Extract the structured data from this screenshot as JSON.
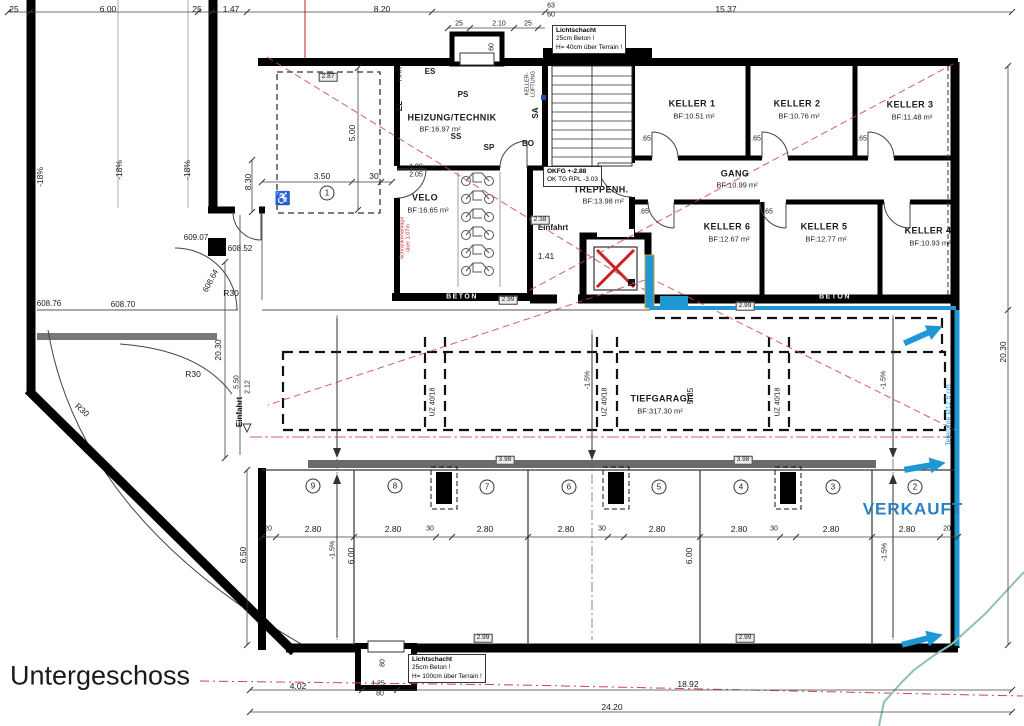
{
  "page_title": "Untergeschoss",
  "colors": {
    "accent_blue": "#1f97d4",
    "verkauft_blue": "#2b7fc4",
    "red_dashed": "#cc4444",
    "beam_gray": "#6a6a6a",
    "terrain_teal": "#8fc0b8",
    "wall_black": "#000000"
  },
  "callouts": [
    {
      "n": "lichtschacht-callout-top",
      "x": 552,
      "y": 25,
      "lines": [
        "Lichtschacht",
        "25cm Beton !",
        "H= 40cm über Terrain !"
      ]
    },
    {
      "n": "okfg-callout",
      "x": 543,
      "y": 166,
      "lines": [
        "OKFG +-2.88",
        "OK TG RPL -3.03"
      ]
    },
    {
      "n": "lichtschacht-callout-bottom",
      "x": 408,
      "y": 654,
      "lines": [
        "Lichtschacht",
        "25cm Beton !",
        "H= 100cm über Terrain !"
      ]
    }
  ],
  "labels": [
    {
      "t": "25",
      "x": 14,
      "y": 9
    },
    {
      "t": "6.00",
      "x": 108,
      "y": 9
    },
    {
      "t": "25",
      "x": 197,
      "y": 9
    },
    {
      "t": "1.47",
      "x": 231,
      "y": 9
    },
    {
      "t": "8.20",
      "x": 382,
      "y": 9
    },
    {
      "t": "63",
      "x": 551,
      "y": 6,
      "c": "d7"
    },
    {
      "t": "60",
      "x": 551,
      "y": 15,
      "c": "d7"
    },
    {
      "t": "15.37",
      "x": 726,
      "y": 9
    },
    {
      "t": "25",
      "x": 459,
      "y": 24,
      "c": "d7"
    },
    {
      "t": "2.10",
      "x": 499,
      "y": 24,
      "c": "d7"
    },
    {
      "t": "25",
      "x": 528,
      "y": 24,
      "c": "d7"
    },
    {
      "t": "60",
      "x": 492,
      "y": 47,
      "r": -90,
      "c": "d7"
    },
    {
      "t": "-18%",
      "x": 40,
      "y": 177,
      "r": -90,
      "c": "slope"
    },
    {
      "t": "-18%",
      "x": 119,
      "y": 170,
      "r": -90,
      "c": "slope"
    },
    {
      "t": "-18%",
      "x": 187,
      "y": 170,
      "r": -90,
      "c": "slope"
    },
    {
      "t": "609.07",
      "x": 196,
      "y": 238,
      "c": "lvl"
    },
    {
      "t": "608.52",
      "x": 240,
      "y": 249,
      "c": "lvl"
    },
    {
      "t": "608.64",
      "x": 211,
      "y": 281,
      "r": -62,
      "c": "lvl"
    },
    {
      "t": "608.76",
      "x": 49,
      "y": 304,
      "c": "lvl"
    },
    {
      "t": "608.70",
      "x": 123,
      "y": 305,
      "c": "lvl"
    },
    {
      "t": "R30",
      "x": 231,
      "y": 293
    },
    {
      "t": "R30",
      "x": 193,
      "y": 374
    },
    {
      "t": "R30",
      "x": 82,
      "y": 410,
      "r": 42
    },
    {
      "t": "8.30",
      "x": 248,
      "y": 182,
      "r": -90
    },
    {
      "t": "20.30",
      "x": 218,
      "y": 350,
      "r": -90
    },
    {
      "t": "5.50",
      "x": 237,
      "y": 382,
      "r": -90,
      "c": "d7"
    },
    {
      "t": "2.12",
      "x": 248,
      "y": 387,
      "r": -90,
      "c": "d7"
    },
    {
      "t": "Einfahrt",
      "x": 240,
      "y": 412,
      "r": -90,
      "c": "dbold"
    },
    {
      "t": "6.50",
      "x": 243,
      "y": 555,
      "r": -90
    },
    {
      "t": "3.50",
      "x": 322,
      "y": 176
    },
    {
      "t": "30",
      "x": 374,
      "y": 176
    },
    {
      "t": "5.00",
      "x": 352,
      "y": 133,
      "r": -90
    },
    {
      "t": "1.08",
      "x": 416,
      "y": 167,
      "c": "d7"
    },
    {
      "t": "2.05",
      "x": 416,
      "y": 175,
      "c": "d7"
    },
    {
      "t": "HEIZUNG/TECHNIK",
      "x": 452,
      "y": 118,
      "c": "room",
      "n": "room-label-heizung"
    },
    {
      "t": "BF:16.97 m²",
      "x": 440,
      "y": 129,
      "c": "area"
    },
    {
      "t": "ES",
      "x": 430,
      "y": 72,
      "c": "dbold"
    },
    {
      "t": "PS",
      "x": 463,
      "y": 95,
      "c": "dbold"
    },
    {
      "t": "SS",
      "x": 456,
      "y": 137,
      "c": "dbold"
    },
    {
      "t": "SP",
      "x": 489,
      "y": 148,
      "c": "dbold"
    },
    {
      "t": "BO",
      "x": 528,
      "y": 144,
      "c": "dbold"
    },
    {
      "t": "EL",
      "x": 400,
      "y": 106,
      "r": -90,
      "c": "dbold"
    },
    {
      "t": "HAK",
      "x": 400,
      "y": 74,
      "r": -90,
      "c": "d7"
    },
    {
      "t": "KELLER-",
      "x": 528,
      "y": 84,
      "r": -90,
      "c": "d6"
    },
    {
      "t": "LÜFTUNG",
      "x": 534,
      "y": 84,
      "r": -90,
      "c": "d6"
    },
    {
      "t": "SA",
      "x": 536,
      "y": 113,
      "r": -90,
      "c": "dbold"
    },
    {
      "t": "VELO",
      "x": 425,
      "y": 198,
      "c": "room",
      "n": "room-label-velo"
    },
    {
      "t": "BF:16.65 m²",
      "x": 428,
      "y": 210,
      "c": "area"
    },
    {
      "t": "Schrankenanlage",
      "x": 403,
      "y": 238,
      "r": -90,
      "c": "red"
    },
    {
      "t": "über 1.07m",
      "x": 409,
      "y": 238,
      "r": -90,
      "c": "red"
    },
    {
      "t": "TREPPENH.",
      "x": 601,
      "y": 190,
      "c": "room",
      "n": "room-label-treppenhaus"
    },
    {
      "t": "BF:13.98 m²",
      "x": 603,
      "y": 201,
      "c": "area"
    },
    {
      "t": "Einfahrt",
      "x": 553,
      "y": 228,
      "c": "dbold"
    },
    {
      "t": "1.41",
      "x": 546,
      "y": 256
    },
    {
      "t": "BETON",
      "x": 392,
      "y": 203,
      "r": -90,
      "c": "beton"
    },
    {
      "t": "BETON",
      "x": 462,
      "y": 297,
      "c": "beton"
    },
    {
      "t": "BETON",
      "x": 835,
      "y": 297,
      "c": "beton"
    },
    {
      "t": "GANG",
      "x": 735,
      "y": 174,
      "c": "room",
      "n": "room-label-gang"
    },
    {
      "t": "BF:10.99 m²",
      "x": 737,
      "y": 185,
      "c": "area"
    },
    {
      "t": "KELLER 1",
      "x": 692,
      "y": 104,
      "c": "room",
      "n": "room-label-keller-1"
    },
    {
      "t": "BF:10.51 m²",
      "x": 694,
      "y": 116,
      "c": "area"
    },
    {
      "t": "KELLER 2",
      "x": 797,
      "y": 104,
      "c": "room",
      "n": "room-label-keller-2"
    },
    {
      "t": "BF:10.76 m²",
      "x": 799,
      "y": 116,
      "c": "area"
    },
    {
      "t": "KELLER 3",
      "x": 910,
      "y": 105,
      "c": "room",
      "n": "room-label-keller-3"
    },
    {
      "t": "BF:11.48 m²",
      "x": 912,
      "y": 117,
      "c": "area"
    },
    {
      "t": "KELLER 6",
      "x": 727,
      "y": 227,
      "c": "room",
      "n": "room-label-keller-6"
    },
    {
      "t": "BF:12.67 m²",
      "x": 729,
      "y": 239,
      "c": "area"
    },
    {
      "t": "KELLER 5",
      "x": 824,
      "y": 227,
      "c": "room",
      "n": "room-label-keller-5"
    },
    {
      "t": "BF:12.77 m²",
      "x": 826,
      "y": 239,
      "c": "area"
    },
    {
      "t": "KELLER 4",
      "x": 928,
      "y": 231,
      "c": "room",
      "n": "room-label-keller-4"
    },
    {
      "t": "BF:10.93 m²",
      "x": 930,
      "y": 243,
      "c": "area"
    },
    {
      "t": ".65",
      "x": 646,
      "y": 139,
      "c": "d7"
    },
    {
      "t": ".65",
      "x": 756,
      "y": 139,
      "c": "d7"
    },
    {
      "t": ".65",
      "x": 862,
      "y": 139,
      "c": "d7"
    },
    {
      "t": ".65",
      "x": 644,
      "y": 212,
      "c": "d7"
    },
    {
      "t": ".65",
      "x": 768,
      "y": 212,
      "c": "d7"
    },
    {
      "t": "TIEFGARAGE",
      "x": 662,
      "y": 399,
      "c": "room",
      "n": "room-label-tiefgarage"
    },
    {
      "t": "BF:317.30 m²",
      "x": 660,
      "y": 411,
      "c": "area"
    },
    {
      "t": "5.85",
      "x": 690,
      "y": 396,
      "r": -90
    },
    {
      "t": "UZ 40/18",
      "x": 433,
      "y": 402,
      "r": -90,
      "c": "d7"
    },
    {
      "t": "UZ 40/18",
      "x": 605,
      "y": 402,
      "r": -90,
      "c": "d7"
    },
    {
      "t": "UZ 40/18",
      "x": 778,
      "y": 402,
      "r": -90,
      "c": "d7"
    },
    {
      "t": "-1.5%",
      "x": 588,
      "y": 380,
      "r": -90,
      "c": "d7"
    },
    {
      "t": "-1.5%",
      "x": 884,
      "y": 380,
      "r": -90,
      "c": "d7"
    },
    {
      "t": "-1.5%",
      "x": 333,
      "y": 550,
      "r": -90,
      "c": "d7"
    },
    {
      "t": "-1.5%",
      "x": 885,
      "y": 552,
      "r": -90,
      "c": "d7"
    },
    {
      "t": "6.00",
      "x": 351,
      "y": 556,
      "r": -90
    },
    {
      "t": "6.00",
      "x": 689,
      "y": 556,
      "r": -90
    },
    {
      "t": "1",
      "x": 327,
      "y": 193,
      "c": "circ",
      "n": "parking-spot-1"
    },
    {
      "t": "9",
      "x": 313,
      "y": 486,
      "c": "circ",
      "n": "parking-spot-9"
    },
    {
      "t": "8",
      "x": 395,
      "y": 486,
      "c": "circ",
      "n": "parking-spot-8"
    },
    {
      "t": "7",
      "x": 487,
      "y": 487,
      "c": "circ",
      "n": "parking-spot-7"
    },
    {
      "t": "6",
      "x": 569,
      "y": 487,
      "c": "circ",
      "n": "parking-spot-6"
    },
    {
      "t": "5",
      "x": 659,
      "y": 487,
      "c": "circ",
      "n": "parking-spot-5"
    },
    {
      "t": "4",
      "x": 741,
      "y": 487,
      "c": "circ",
      "n": "parking-spot-4"
    },
    {
      "t": "3",
      "x": 833,
      "y": 487,
      "c": "circ",
      "n": "parking-spot-3"
    },
    {
      "t": "2",
      "x": 915,
      "y": 487,
      "c": "circ",
      "n": "parking-spot-2"
    },
    {
      "t": "♿",
      "x": 283,
      "y": 198,
      "c": "wc",
      "n": "wheelchair-icon"
    },
    {
      "t": "2.87",
      "x": 328,
      "y": 77,
      "c": "box"
    },
    {
      "t": "2.38",
      "x": 540,
      "y": 220,
      "c": "box"
    },
    {
      "t": "2.99",
      "x": 745,
      "y": 306,
      "c": "box"
    },
    {
      "t": "2.99",
      "x": 508,
      "y": 300,
      "c": "box"
    },
    {
      "t": "3.98",
      "x": 505,
      "y": 460,
      "c": "box"
    },
    {
      "t": "3.98",
      "x": 743,
      "y": 460,
      "c": "box"
    },
    {
      "t": "2.99",
      "x": 483,
      "y": 638,
      "c": "box"
    },
    {
      "t": "2.99",
      "x": 745,
      "y": 638,
      "c": "box"
    },
    {
      "t": "20",
      "x": 268,
      "y": 529,
      "c": "d7"
    },
    {
      "t": "2.80",
      "x": 313,
      "y": 529
    },
    {
      "t": "2.80",
      "x": 393,
      "y": 529
    },
    {
      "t": "30",
      "x": 430,
      "y": 529,
      "c": "d7"
    },
    {
      "t": "2.80",
      "x": 485,
      "y": 529
    },
    {
      "t": "2.80",
      "x": 566,
      "y": 529
    },
    {
      "t": "30",
      "x": 602,
      "y": 529,
      "c": "d7"
    },
    {
      "t": "2.80",
      "x": 657,
      "y": 529
    },
    {
      "t": "2.80",
      "x": 739,
      "y": 529
    },
    {
      "t": "30",
      "x": 774,
      "y": 529,
      "c": "d7"
    },
    {
      "t": "2.80",
      "x": 831,
      "y": 529
    },
    {
      "t": "2.80",
      "x": 907,
      "y": 529
    },
    {
      "t": "20",
      "x": 947,
      "y": 529,
      "c": "d7"
    },
    {
      "t": "20.30",
      "x": 1003,
      "y": 352,
      "r": -90
    },
    {
      "t": "Telerohre Ø12.5 cm",
      "x": 949,
      "y": 415,
      "r": -90,
      "c": "blue"
    },
    {
      "t": "VERKAUFT",
      "x": 913,
      "y": 509,
      "c": "verk",
      "n": "verkauft-label"
    },
    {
      "t": "Untergeschoss",
      "x": 100,
      "y": 676,
      "c": "title",
      "n": "page-title"
    },
    {
      "t": "4.02",
      "x": 298,
      "y": 686
    },
    {
      "t": "1.25",
      "x": 378,
      "y": 684,
      "c": "d7"
    },
    {
      "t": "80",
      "x": 380,
      "y": 694,
      "c": "d7"
    },
    {
      "t": "80",
      "x": 383,
      "y": 663,
      "r": -90,
      "c": "d7"
    },
    {
      "t": "18.92",
      "x": 688,
      "y": 684
    },
    {
      "t": "24.20",
      "x": 612,
      "y": 707
    }
  ]
}
